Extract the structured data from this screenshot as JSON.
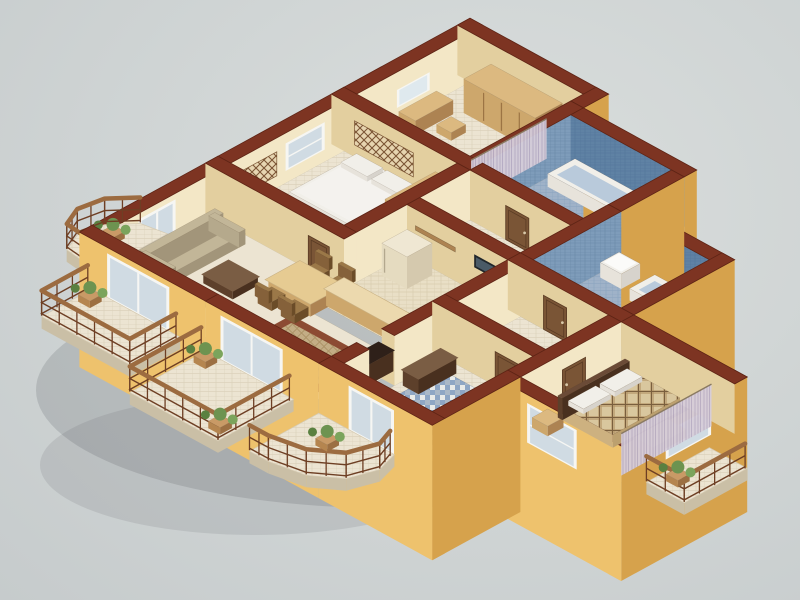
{
  "scene": {
    "description": "Isometric 3D cutaway floor plan render of an apartment with tan exterior walls, red-brown cut wall tops, two blue tiled bathrooms, bedrooms, open kitchen with bar counter and balconies",
    "background": "neutral studio gray"
  },
  "palette": {
    "bg1": "#dadedd",
    "bg2": "#cfd4d4",
    "bg3": "#c6cbcc",
    "shadow": "rgba(96,100,106,0.22)",
    "wallTop": "#7d3422",
    "wallTopEdge": "#5e2415",
    "extSE": "#d6a24c",
    "extSW": "#eec26d",
    "intSE": "#f3e7c6",
    "intSW": "#e3cf9f",
    "floor": "#ece4d2",
    "floorLine": "#dcd2bc",
    "kfloor": "#e9dfc6",
    "kfloorLine": "#d9cdae",
    "bathFloor": "#9fb2c8",
    "bathFloorLine": "#8aa3be",
    "bathWallSE": "#7e9cba",
    "bathWallSEline": "#6a89a8",
    "bathWallSW": "#5f82a4",
    "bathWallSWline": "#52749a",
    "mosaicA": "#8ea6c4",
    "mosaicB": "#e8eae8",
    "mosaicC": "#5f7da1",
    "wood": "#c9a169",
    "woodTop": "#dcb980",
    "woodSE": "#ad8352",
    "woodSW": "#cda76c",
    "darkTop": "#6b4b37",
    "darkSE": "#49301f",
    "darkSW": "#5d402b",
    "whiteTop": "#f1efe9",
    "whiteSE": "#d7d3cc",
    "whiteSW": "#e7e3db",
    "creamTop": "#efe7d3",
    "creamSE": "#d5c9ae",
    "creamSW": "#e5dbc0",
    "sofaTop": "#c2b698",
    "sofaSE": "#a2957a",
    "sofaSW": "#b5a98c",
    "chairTop": "#9b7848",
    "chairSE": "#6b4c28",
    "chairSW": "#85613a",
    "glass": "#cdd9e2",
    "frame": "#f6f6f3",
    "door": "#7a5536",
    "doorEdge": "#5a3b24",
    "knob": "#d8c8a8",
    "curtain": "#d6cdd9",
    "curtainLine": "#b9aec4",
    "plaid": "#d9c79e",
    "plaidLine": "#7a5f3e",
    "plaidSoft": "#b49468",
    "rug": "#8c4b33",
    "rugIn": "#c3ad85",
    "rugInLine": "#a98f62",
    "rail": "#6e3f24",
    "railTop": "#9c6b40",
    "plant": "#6d9350",
    "plantDark": "#5a8040",
    "plantLight": "#7ba45c",
    "potTop": "#c99a66",
    "potSE": "#9c6f42",
    "potSW": "#b5854f",
    "tv": "#20262b",
    "tvScreen": "#4a5a66",
    "slab": "#eae2d0",
    "slabSide": "#cabfa6",
    "slabEdge": "#d5cab2",
    "counterLid": "#ecd9ae",
    "counterLidEdge": "#c9b183",
    "tableLid": "#e6cb92",
    "latticeBg": "rgba(230,212,176,0.95)",
    "latticeLine": "#7a5434",
    "mirror": "#dfe9ee",
    "tubInner": "#b9cadb",
    "lampShade": "#f5f0e0",
    "lampShadeEdge": "#d8cdb0",
    "lampPole": "#5a4632",
    "mattress": "#f4f2ee"
  },
  "rooms": [
    {
      "id": "dressing-room",
      "rect": [
        0,
        0,
        5.4,
        5.4
      ],
      "floor": "tile"
    },
    {
      "id": "bathroom-1",
      "rect": [
        6.0,
        1.2,
        10.8,
        5.4
      ],
      "floor": "bath"
    },
    {
      "id": "bedroom-2",
      "rect": [
        0,
        6.0,
        5.4,
        11.4
      ],
      "floor": "tile",
      "inset": {
        "rect": [
          1.2,
          9.9,
          4.6,
          11.2
        ],
        "fill": "mosaic"
      }
    },
    {
      "id": "corridor",
      "rect": [
        6.0,
        6.0,
        10.8,
        8.4
      ],
      "floor": "tile"
    },
    {
      "id": "bathroom-2",
      "rect": [
        11.4,
        4.2,
        15.6,
        8.4
      ],
      "floor": "bath"
    },
    {
      "id": "hallway-east",
      "rect": [
        11.4,
        9.0,
        15.6,
        12.0
      ],
      "floor": "tile"
    },
    {
      "id": "kitchen",
      "rect": [
        6.0,
        9.0,
        10.8,
        13.2
      ],
      "floor": "ktile"
    },
    {
      "id": "master-bedroom",
      "rect": [
        16.2,
        9.0,
        21.0,
        13.8
      ],
      "floor": "plain",
      "inset": {
        "rect": [
          18.0,
          10.1,
          20.1,
          12.9
        ],
        "fill": "rug"
      }
    },
    {
      "id": "living-dining",
      "poly": [
        [
          0,
          12
        ],
        [
          5.4,
          12
        ],
        [
          5.4,
          13.8
        ],
        [
          10.8,
          13.8
        ],
        [
          10.8,
          17.4
        ],
        [
          0,
          17.4
        ]
      ],
      "floor": "plain",
      "inset": {
        "rect": [
          5.9,
          14.4,
          9.9,
          17.1
        ],
        "fill": "rug"
      }
    },
    {
      "id": "entry-hall",
      "rect": [
        11.4,
        12.6,
        15.6,
        17.4
      ],
      "floor": "tile",
      "inset": {
        "rect": [
          11.9,
          13.2,
          15.1,
          16.9
        ],
        "fill": "mosaic"
      }
    }
  ],
  "walls": [
    [
      -0.6,
      -0.6,
      6.0,
      0.0,
      "e",
      "i",
      6
    ],
    [
      5.4,
      -0.6,
      6.0,
      0.6,
      "e",
      "x",
      6.6
    ],
    [
      5.4,
      0.6,
      6.0,
      6.0,
      "t",
      "x",
      12
    ],
    [
      6.0,
      0.6,
      11.4,
      1.2,
      "e",
      "t",
      12.6
    ],
    [
      10.8,
      1.2,
      11.4,
      4.2,
      "e",
      "x",
      15.6
    ],
    [
      11.4,
      3.6,
      16.2,
      4.2,
      "e",
      "t",
      15.0
    ],
    [
      10.8,
      4.2,
      11.4,
      8.4,
      "t",
      "x",
      19.8
    ],
    [
      15.6,
      3.6,
      16.2,
      8.4,
      "e",
      "x",
      24.6
    ],
    [
      10.8,
      8.4,
      16.2,
      9.0,
      "x",
      "i",
      25.2
    ],
    [
      16.2,
      8.4,
      21.6,
      9.0,
      "x",
      "i",
      30.6
    ],
    [
      21.0,
      8.4,
      21.6,
      14.4,
      "e",
      "e",
      29.4
    ],
    [
      16.2,
      13.8,
      21.6,
      14.4,
      "x",
      "e",
      30.0
    ],
    [
      15.6,
      9.0,
      16.2,
      13.8,
      "i",
      "x",
      29.9
    ],
    [
      10.8,
      12.0,
      16.2,
      12.6,
      "i",
      "i",
      28.8
    ],
    [
      10.8,
      9.0,
      11.4,
      12.0,
      "i",
      "i",
      23.4
    ],
    [
      6.0,
      8.4,
      10.8,
      9.0,
      "x",
      "i",
      19.8
    ],
    [
      5.4,
      6.0,
      6.0,
      12.0,
      "i",
      "i",
      18.0
    ],
    [
      -0.6,
      5.4,
      6.0,
      6.0,
      "x",
      "i",
      12.0
    ],
    [
      6.0,
      5.4,
      11.4,
      6.0,
      "x",
      "i",
      17.4
    ],
    [
      -0.6,
      11.4,
      6.0,
      12.0,
      "i",
      "i",
      18.0
    ],
    [
      10.8,
      12.6,
      11.4,
      15.0,
      "i",
      "i",
      26.4
    ],
    [
      10.8,
      16.2,
      11.4,
      17.4,
      "i",
      "x",
      28.79
    ],
    [
      15.6,
      13.8,
      16.2,
      18.0,
      "e",
      "e",
      34.2
    ],
    [
      10.8,
      17.4,
      16.2,
      18.0,
      "e",
      "e",
      34.2
    ],
    [
      -0.6,
      17.4,
      5.4,
      18.0,
      "x",
      "e",
      23.4
    ],
    [
      5.4,
      17.4,
      10.8,
      18.0,
      "x",
      "e",
      28.8
    ],
    [
      -0.6,
      -0.6,
      0.0,
      5.4,
      "i",
      "x",
      5.4
    ],
    [
      -0.6,
      5.4,
      0.0,
      11.4,
      "i",
      "x",
      11.4
    ],
    [
      -0.6,
      11.4,
      0.0,
      17.4,
      "i",
      "e",
      17.4
    ]
  ],
  "openings": [
    {
      "kind": "mirror",
      "face": "SE",
      "c": 0,
      "r": [
        2.0,
        3.4
      ],
      "z": [
        14,
        32
      ],
      "k": 5.45
    },
    {
      "kind": "window",
      "face": "SE",
      "c": 0,
      "r": [
        7.0,
        8.7
      ],
      "z": [
        12,
        38
      ],
      "k": 11.45
    },
    {
      "kind": "lattice",
      "face": "SE",
      "c": 0,
      "r": [
        9.2,
        11.0
      ],
      "z": [
        12,
        36
      ],
      "k": 11.46
    },
    {
      "kind": "lattice",
      "face": "SW",
      "c": 6.0,
      "r": [
        0.5,
        3.3
      ],
      "z": [
        12,
        36
      ],
      "k": 12.05
    },
    {
      "kind": "glass",
      "face": "SE",
      "c": 0,
      "r": [
        14.1,
        15.7
      ],
      "z": [
        0,
        42
      ],
      "k": 17.45
    },
    {
      "kind": "door",
      "face": "SW",
      "c": 6.0,
      "r": [
        7.7,
        8.8
      ],
      "z": [
        0,
        34
      ],
      "k": 17.46
    },
    {
      "kind": "door",
      "face": "SW",
      "c": 12.0,
      "r": [
        4.3,
        5.3
      ],
      "z": [
        0,
        34
      ],
      "k": 18.05
    },
    {
      "kind": "tv",
      "face": "SW",
      "c": 9.0,
      "r": [
        9.2,
        10.5
      ],
      "z": [
        24,
        37
      ],
      "k": 19.85
    },
    {
      "kind": "shelf",
      "face": "SW",
      "c": 9.0,
      "r": [
        6.4,
        8.3
      ],
      "z": [
        29,
        33.5
      ],
      "k": 19.86
    },
    {
      "kind": "glass",
      "face": "SW",
      "c": 18.0,
      "r": [
        0.8,
        3.6
      ],
      "z": [
        0,
        42
      ],
      "k": 23.45
    },
    {
      "kind": "door",
      "face": "SW",
      "c": 9.0,
      "r": [
        12.5,
        13.6
      ],
      "z": [
        0,
        34
      ],
      "k": 25.25
    },
    {
      "kind": "door",
      "face": "SW",
      "c": 12.6,
      "r": [
        13.8,
        14.9
      ],
      "z": [
        0,
        34
      ],
      "k": 28.85
    },
    {
      "kind": "glass",
      "face": "SW",
      "c": 18.0,
      "r": [
        6.2,
        9.0
      ],
      "z": [
        0,
        42
      ],
      "k": 28.86
    },
    {
      "kind": "window",
      "face": "SE",
      "c": 21.6,
      "r": [
        10.2,
        12.2
      ],
      "z": [
        12,
        38
      ],
      "k": 29.45
    },
    {
      "kind": "window",
      "face": "SW",
      "c": 14.4,
      "r": [
        17.2,
        19.4
      ],
      "z": [
        2,
        40
      ],
      "k": 30.02
    },
    {
      "kind": "door",
      "face": "SE",
      "c": 16.2,
      "r": [
        10.7,
        11.8
      ],
      "z": [
        0,
        34
      ],
      "k": 30.05
    },
    {
      "kind": "glass",
      "face": "SW",
      "c": 18.0,
      "r": [
        12.3,
        14.3
      ],
      "z": [
        0,
        42
      ],
      "k": 34.25
    }
  ],
  "furniture": [
    {
      "kind": "dresser",
      "r": [
        0.2,
        1.8,
        1.0,
        3.6
      ],
      "h": 14,
      "k": 5.5
    },
    {
      "kind": "stool",
      "r": [
        1.4,
        2.3,
        2.1,
        3.0
      ],
      "h": 8,
      "k": 5.6
    },
    {
      "kind": "wardrobe",
      "r": [
        1.2,
        0.2,
        4.6,
        1.5
      ],
      "h": 34,
      "k": 6.2
    },
    {
      "kind": "bench-white",
      "r": [
        1.6,
        3.9,
        3.6,
        5.1
      ],
      "h": 10,
      "k": 8.9
    },
    {
      "kind": "curtain",
      "face": "SE",
      "c": 5.25,
      "r": [
        1.6,
        5.2
      ],
      "z": [
        2,
        42
      ],
      "k": 12.1
    },
    {
      "kind": "basin",
      "r": [
        6.3,
        4.3,
        7.3,
        5.3
      ],
      "h": 15,
      "k": 12.7
    },
    {
      "kind": "tub",
      "r": [
        6.4,
        1.4,
        10.2,
        2.7
      ],
      "h": 13,
      "k": 13.0
    },
    {
      "kind": "bed",
      "r": [
        1.0,
        6.4,
        4.0,
        9.6
      ],
      "orient": "b0",
      "k": 13.7
    },
    {
      "kind": "nightstand",
      "r": [
        0.2,
        9.9,
        1.0,
        10.7
      ],
      "h": 10,
      "k": 11.8
    },
    {
      "kind": "wardrobe",
      "r": [
        4.55,
        6.2,
        5.35,
        8.6
      ],
      "h": 34,
      "k": 14.05
    },
    {
      "kind": "wc",
      "r": [
        9.4,
        4.5,
        10.3,
        5.3
      ],
      "h": 9,
      "tank": true,
      "k": 15.7
    },
    {
      "kind": "shoecab",
      "r": [
        9.85,
        6.2,
        10.7,
        8.2
      ],
      "h": 26,
      "k": 19.0
    },
    {
      "kind": "basin",
      "r": [
        11.6,
        4.5,
        12.6,
        5.4
      ],
      "h": 15,
      "k": 20.0
    },
    {
      "kind": "wc",
      "r": [
        11.6,
        7.4,
        12.5,
        8.3
      ],
      "h": 9,
      "tank": true,
      "k": 20.4
    },
    {
      "kind": "tub",
      "r": [
        13.3,
        4.5,
        15.4,
        5.7
      ],
      "h": 12,
      "k": 21.2
    },
    {
      "kind": "bidet",
      "r": [
        13.0,
        7.5,
        13.9,
        8.3
      ],
      "h": 9,
      "k": 21.4
    },
    {
      "kind": "fridge",
      "r": [
        6.3,
        9.3,
        7.5,
        10.5
      ],
      "h": 32,
      "k": 19.9
    },
    {
      "kind": "counter",
      "r": [
        9.8,
        9.3,
        10.6,
        12.3
      ],
      "h": 16,
      "k": 23.0
    },
    {
      "kind": "flat",
      "r": [
        9.95,
        10.3,
        10.5,
        11.3
      ],
      "z": 16.8,
      "fill": "#f4f4f1",
      "k": 23.05
    },
    {
      "kind": "counter",
      "r": [
        6.3,
        12.3,
        10.6,
        13.15
      ],
      "h": 16,
      "k": 23.85
    },
    {
      "kind": "chair",
      "p": [
        4.9,
        12.25
      ],
      "or": "N",
      "k": 18.3
    },
    {
      "kind": "chair",
      "p": [
        6.0,
        12.25
      ],
      "or": "N",
      "k": 18.35
    },
    {
      "kind": "sofa",
      "r": [
        0.25,
        12.4,
        1.7,
        16.0
      ],
      "k": 18.2
    },
    {
      "kind": "table",
      "r": [
        4.4,
        12.5,
        6.4,
        14.0
      ],
      "h": 13,
      "k": 20.5
    },
    {
      "kind": "chair",
      "p": [
        4.9,
        14.35
      ],
      "or": "S",
      "k": 20.7
    },
    {
      "kind": "chair",
      "p": [
        6.0,
        14.35
      ],
      "or": "S",
      "k": 20.75
    },
    {
      "kind": "coffee",
      "r": [
        2.4,
        13.9,
        3.8,
        15.1
      ],
      "h": 8,
      "k": 19.1
    },
    {
      "kind": "armchair",
      "r": [
        2.3,
        16.0,
        3.5,
        17.3
      ],
      "k": 20.9
    },
    {
      "kind": "lamp",
      "p": [
        4.9,
        16.9
      ],
      "k": 23.3
    },
    {
      "kind": "lamp",
      "p": [
        10.4,
        13.6
      ],
      "k": 24.2
    },
    {
      "kind": "tvcab",
      "r": [
        10.05,
        14.4,
        10.75,
        16.9
      ],
      "h": 20,
      "k": 27.75
    },
    {
      "kind": "console",
      "r": [
        11.6,
        13.0,
        12.35,
        14.8
      ],
      "h": 15,
      "k": 28.9
    },
    {
      "kind": "plaidbed",
      "r": [
        16.9,
        9.3,
        19.3,
        12.5
      ],
      "k": 31.9
    },
    {
      "kind": "nightstand",
      "r": [
        16.5,
        12.8,
        17.25,
        13.55
      ],
      "h": 10,
      "k": 30.9
    },
    {
      "kind": "bench",
      "r": [
        19.7,
        10.3,
        20.6,
        11.9
      ],
      "h": 8,
      "k": 32.7
    },
    {
      "kind": "curtain",
      "face": "SE",
      "c": 20.8,
      "r": [
        9.3,
        13.6
      ],
      "z": [
        2,
        44
      ],
      "k": 36.1
    },
    {
      "kind": "plant",
      "p": [
        -1.7,
        15.3
      ],
      "k": 17.8
    },
    {
      "kind": "plant",
      "p": [
        0.5,
        18.6
      ],
      "k": 25.0
    },
    {
      "kind": "plant",
      "p": [
        5.9,
        18.5
      ],
      "k": 31.5
    },
    {
      "kind": "plant",
      "p": [
        9.1,
        21.0
      ],
      "k": 31.65
    },
    {
      "kind": "plant",
      "p": [
        12.4,
        19.2
      ],
      "k": 34.8
    },
    {
      "kind": "plant",
      "p": [
        22.3,
        12.4
      ],
      "k": 36.9
    }
  ],
  "balconies": [
    {
      "id": "balcony-west-arc",
      "pts": [
        [
          -0.6,
          13.8
        ],
        [
          -1.7,
          14.0
        ],
        [
          -2.5,
          14.9
        ],
        [
          -2.7,
          16.0
        ],
        [
          -2.3,
          16.9
        ],
        [
          -0.6,
          17.1
        ]
      ],
      "sideEdges": [
        1,
        2,
        3,
        4
      ],
      "rail": [
        [
          -1.7,
          14.0
        ],
        [
          -2.5,
          14.9
        ],
        [
          -2.7,
          16.0
        ],
        [
          -2.3,
          16.9
        ],
        [
          -0.6,
          17.1
        ]
      ],
      "k": 17.6
    },
    {
      "id": "balcony-southwest-1",
      "pts": [
        [
          0,
          18
        ],
        [
          4.2,
          18
        ],
        [
          4.2,
          20.4
        ],
        [
          0,
          20.4
        ]
      ],
      "sideEdges": [
        1,
        2
      ],
      "rail": [
        [
          4.2,
          18.2
        ],
        [
          4.2,
          20.4
        ],
        [
          0,
          20.4
        ],
        [
          0,
          18.2
        ]
      ],
      "k": 24.6
    },
    {
      "id": "balcony-southwest-2",
      "pts": [
        [
          5.4,
          18
        ],
        [
          9.6,
          18
        ],
        [
          9.6,
          21.6
        ],
        [
          5.4,
          21.6
        ]
      ],
      "sideEdges": [
        1,
        2
      ],
      "rail": [
        [
          9.6,
          18.2
        ],
        [
          9.6,
          21.6
        ],
        [
          5.4,
          21.6
        ],
        [
          5.4,
          18.2
        ]
      ],
      "k": 31.2
    },
    {
      "id": "entry-porch",
      "pts": [
        [
          10.8,
          18
        ],
        [
          14.4,
          18
        ],
        [
          14.7,
          19.0
        ],
        [
          14.3,
          20.2
        ],
        [
          13.2,
          21.0
        ],
        [
          11.7,
          21.3
        ],
        [
          10.8,
          21.3
        ]
      ],
      "sideEdges": [
        1,
        2,
        3,
        4,
        5
      ],
      "rail": [
        [
          14.4,
          18.2
        ],
        [
          14.7,
          19.0
        ],
        [
          14.3,
          20.2
        ],
        [
          13.2,
          21.0
        ],
        [
          11.7,
          21.3
        ],
        [
          10.8,
          21.3
        ]
      ],
      "k": 34.5
    },
    {
      "id": "balcony-master",
      "pts": [
        [
          21.6,
          10.2
        ],
        [
          23.4,
          10.2
        ],
        [
          23.4,
          13.2
        ],
        [
          21.6,
          13.2
        ]
      ],
      "sideEdges": [
        1,
        2
      ],
      "rail": [
        [
          23.4,
          10.3
        ],
        [
          23.4,
          13.2
        ],
        [
          21.6,
          13.2
        ]
      ],
      "k": 36.6
    }
  ]
}
